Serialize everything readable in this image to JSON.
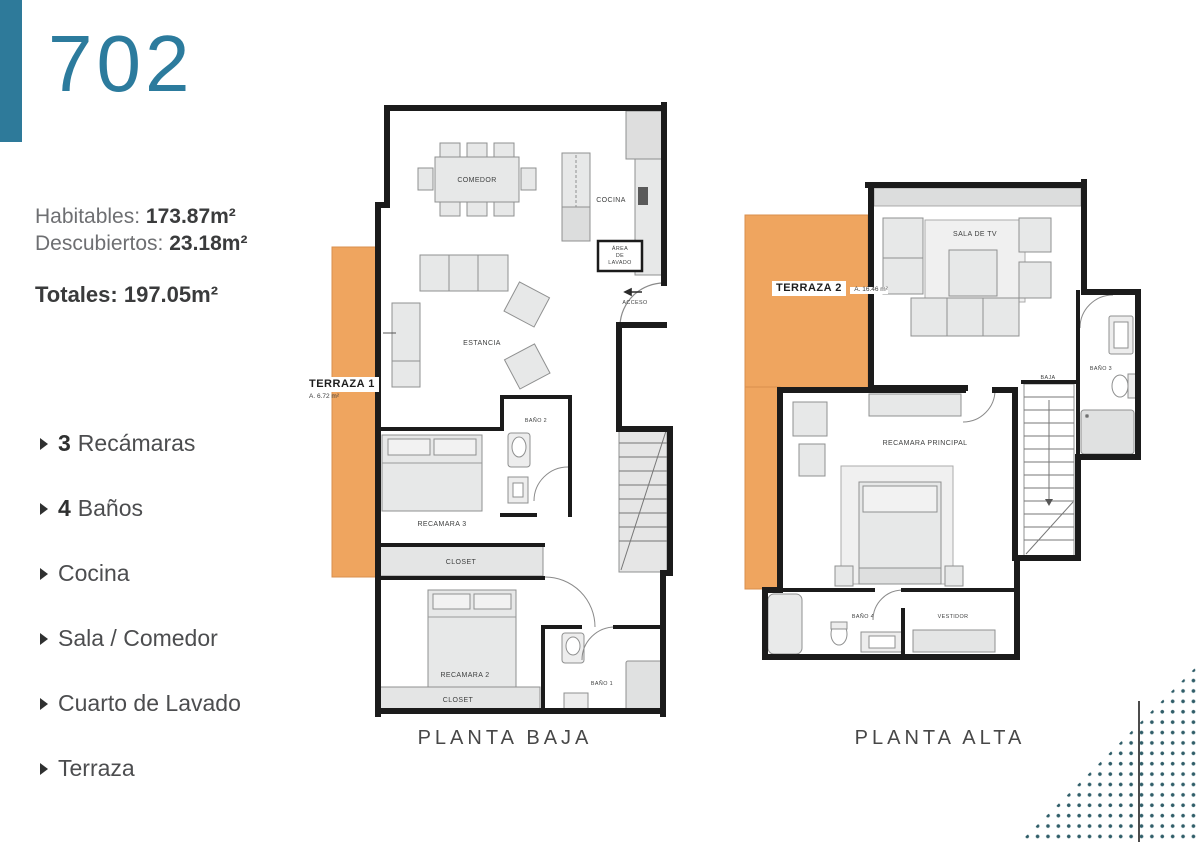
{
  "unit": {
    "number": "702"
  },
  "areas": {
    "habitables_label": "Habitables:",
    "habitables_value": "173.87m²",
    "descubiertos_label": "Descubiertos:",
    "descubiertos_value": "23.18m²",
    "totales_label": "Totales:",
    "totales_value": "197.05m²"
  },
  "features": [
    {
      "qty": "3",
      "label": "Recámaras"
    },
    {
      "qty": "4",
      "label": "Baños"
    },
    {
      "qty": "",
      "label": "Cocina"
    },
    {
      "qty": "",
      "label": "Sala / Comedor"
    },
    {
      "qty": "",
      "label": "Cuarto de Lavado"
    },
    {
      "qty": "",
      "label": "Terraza"
    }
  ],
  "pb": {
    "caption": "PLANTA BAJA",
    "comedor": "COMEDOR",
    "cocina": "COCINA",
    "lavado1": "ÁREA",
    "lavado2": "DE",
    "lavado3": "LAVADO",
    "acceso": "ACCESO",
    "estancia": "ESTANCIA",
    "bano2": "BAÑO 2",
    "recamara3": "RECAMARA 3",
    "closet_a": "CLOSET",
    "recamara2": "RECAMARA 2",
    "closet_b": "CLOSET",
    "bano1": "BAÑO 1",
    "terraza_name": "TERRAZA 1",
    "terraza_area": "A. 6.72 m²"
  },
  "pa": {
    "caption": "PLANTA ALTA",
    "sala_tv": "SALA DE TV",
    "bano3": "BAÑO 3",
    "baja": "BAJA",
    "recamara_principal": "RECAMARA PRINCIPAL",
    "bano4": "BAÑO 4",
    "vestidor": "VESTIDOR",
    "terraza_name": "TERRAZA 2",
    "terraza_area": "A. 16.46 m²"
  },
  "colors": {
    "accent_teal": "#2E7A9A",
    "terrace_orange": "#EFA55F",
    "wall_black": "#1B1B1B",
    "dots_teal": "#2F5D68"
  }
}
